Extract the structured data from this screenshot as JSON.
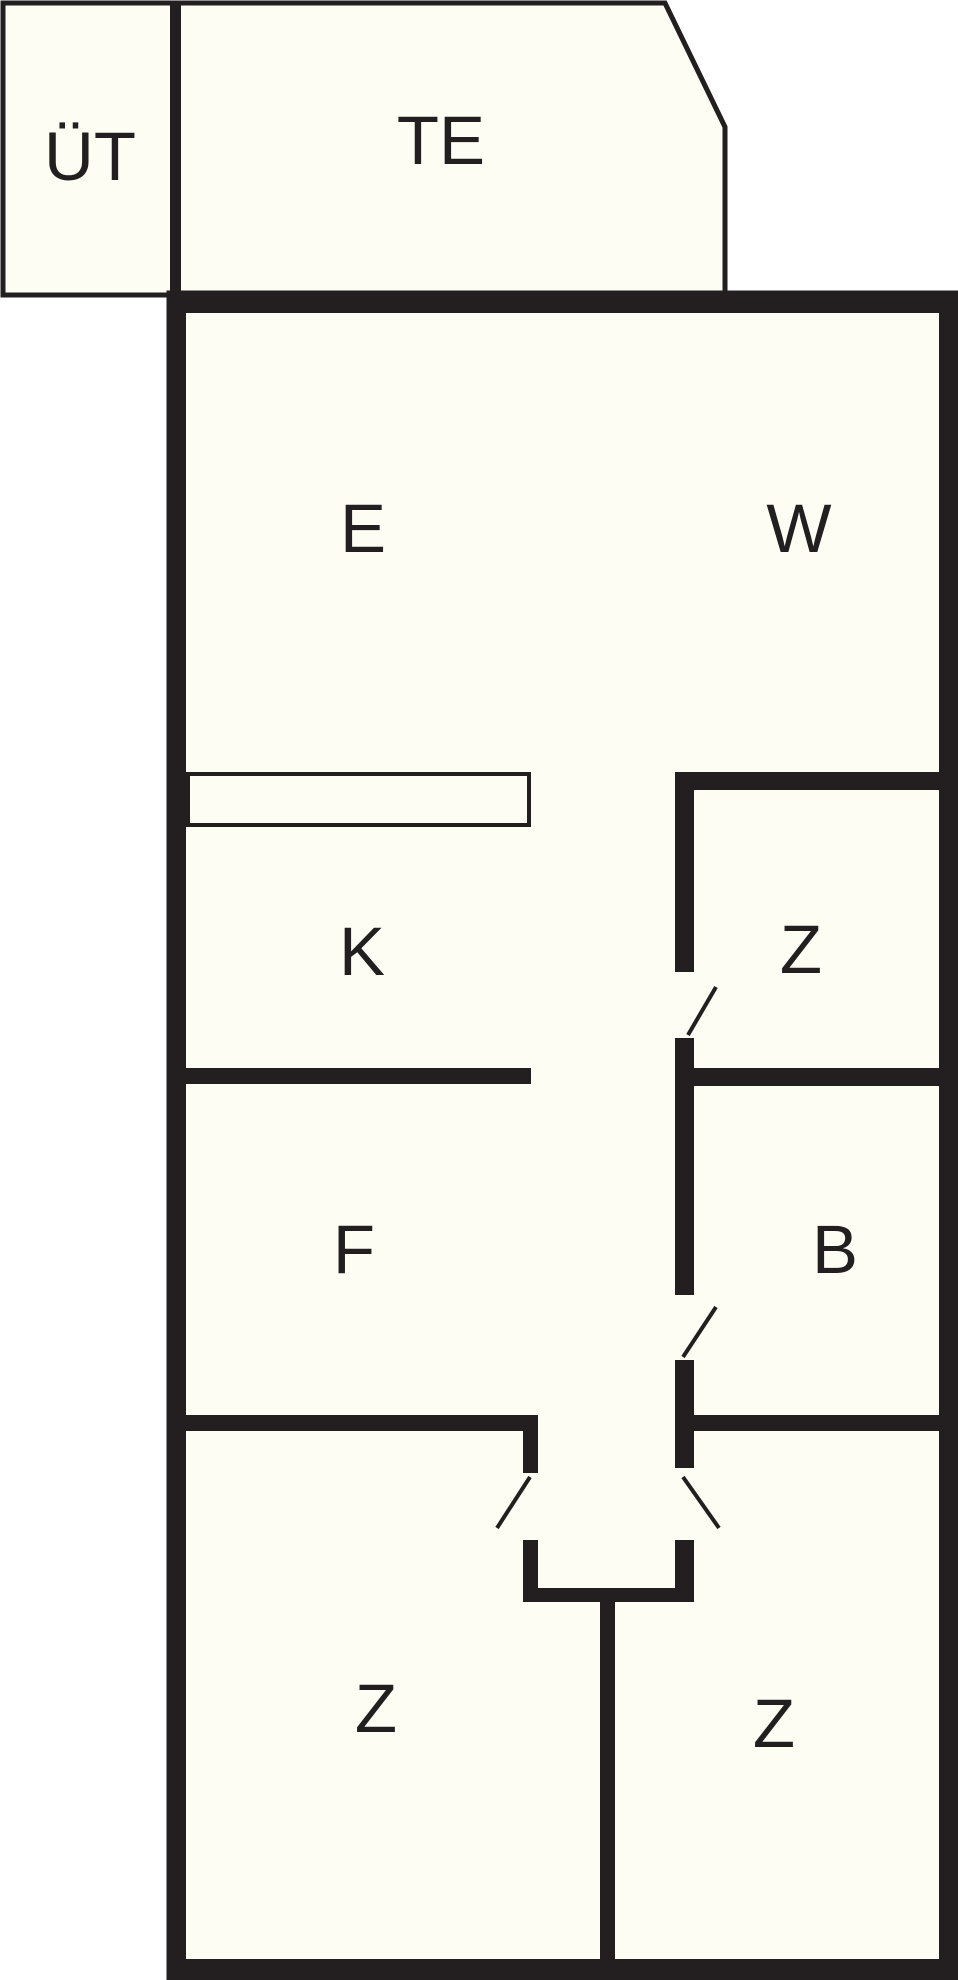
{
  "document": {
    "type": "floor-plan"
  },
  "colors": {
    "wall": "#231f20",
    "room-fill": "#fdfdf4",
    "background": "#ffffff",
    "label": "#231f20"
  },
  "rooms": [
    {
      "id": "uet",
      "label": "ÜT"
    },
    {
      "id": "te",
      "label": "TE"
    },
    {
      "id": "e",
      "label": "E"
    },
    {
      "id": "w",
      "label": "W"
    },
    {
      "id": "k",
      "label": "K"
    },
    {
      "id": "z-middle-right",
      "label": "Z"
    },
    {
      "id": "f",
      "label": "F"
    },
    {
      "id": "b",
      "label": "B"
    },
    {
      "id": "z-bottom-left",
      "label": "Z"
    },
    {
      "id": "z-bottom-right",
      "label": "Z"
    }
  ]
}
